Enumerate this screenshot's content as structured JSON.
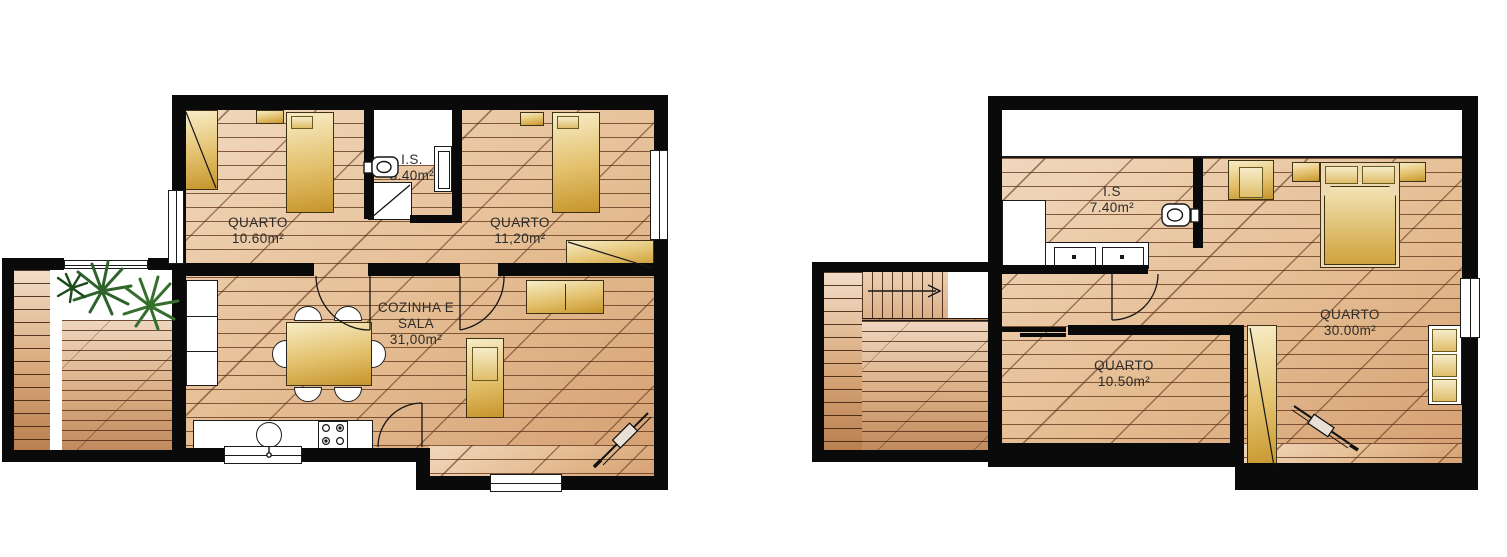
{
  "drawing_type": "residential floor plans (two storeys)",
  "colors": {
    "wall": "#0a0a0a",
    "floor_light": "#f0d8bd",
    "floor_dark": "#d6a174",
    "furniture_gold": "#c6952c",
    "plant_green": "#2e6329",
    "label_text": "#2e2c29",
    "background": "#ffffff"
  },
  "left_plan": {
    "rooms": {
      "bedroom1": {
        "name": "QUARTO",
        "area": "10.60m²"
      },
      "bathroom": {
        "name": "I.S.",
        "area": "3.40m²"
      },
      "bedroom2": {
        "name": "QUARTO",
        "area": "11,20m²"
      },
      "living": {
        "name_line1": "COZINHA E",
        "name_line2": "SALA",
        "area": "31,00m²"
      }
    }
  },
  "right_plan": {
    "rooms": {
      "bathroom": {
        "name": "I.S",
        "area": "7.40m²"
      },
      "bedroom_master": {
        "name": "QUARTO",
        "area": "30.00m²"
      },
      "bedroom_small": {
        "name": "QUARTO",
        "area": "10.50m²"
      }
    }
  }
}
